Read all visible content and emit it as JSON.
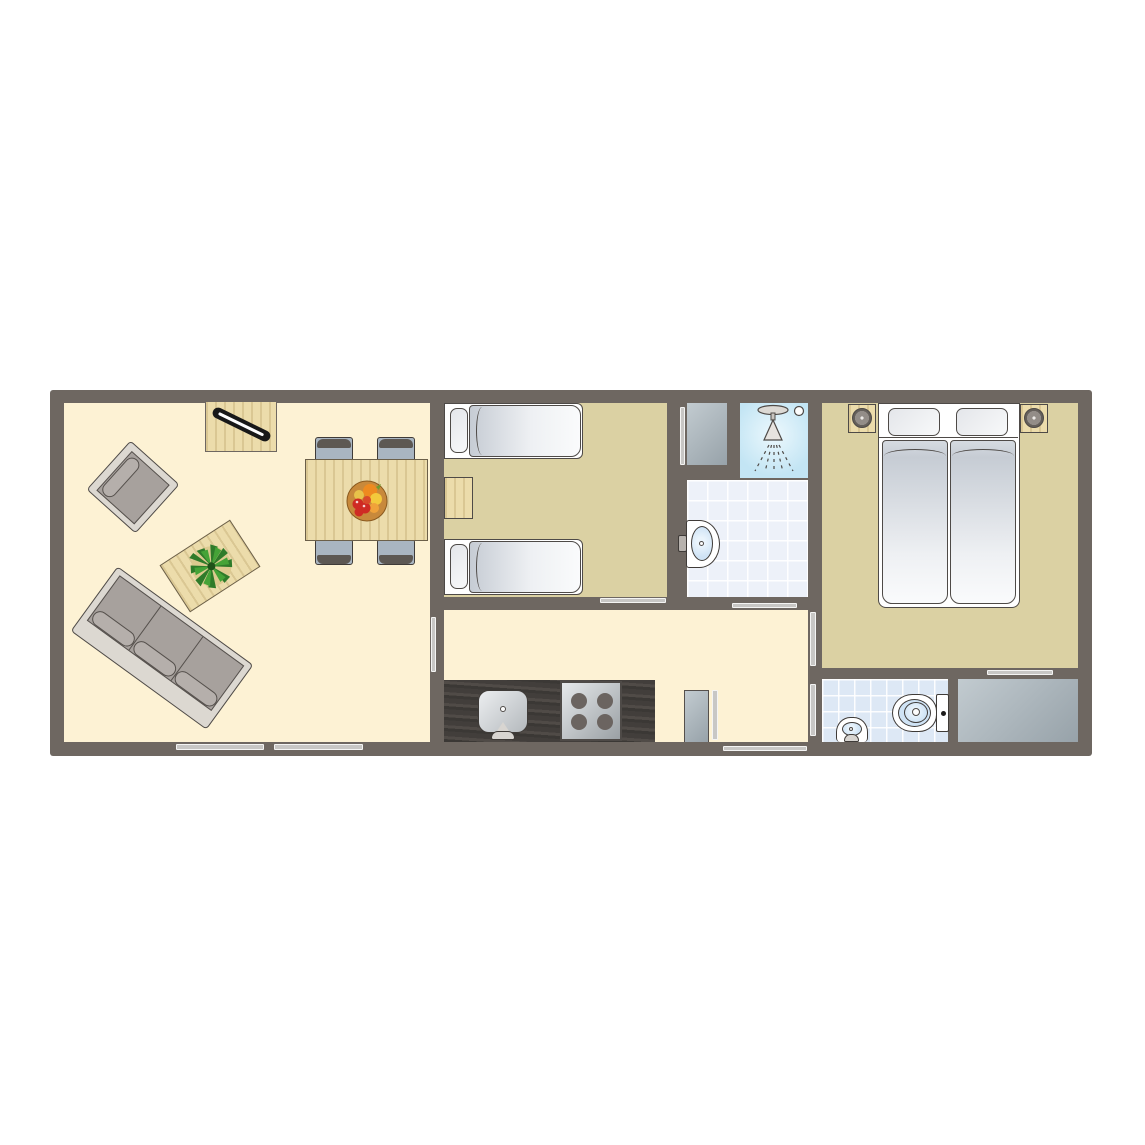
{
  "document": {
    "type": "architectural floor plan",
    "description": "Top-down floor plan of a single-storey holiday lodge: open living/dining room on the left, twin bedroom and bathroom in the middle, double bedroom on the right, kitchen corridor along the bottom with separate toilet room and storage room"
  },
  "rooms": [
    {
      "id": "living-room",
      "label": "living-dining-room"
    },
    {
      "id": "twin-bedroom",
      "label": "bedroom-two-single-beds"
    },
    {
      "id": "bathroom",
      "label": "bathroom-shower-washbasin"
    },
    {
      "id": "double-bedroom",
      "label": "bedroom-double-bed"
    },
    {
      "id": "hallway-kitchen",
      "label": "hallway-with-kitchenette"
    },
    {
      "id": "toilet-room",
      "label": "separate-toilet"
    },
    {
      "id": "storage-room",
      "label": "storage"
    },
    {
      "id": "closet-bathroom",
      "label": "utility-closet"
    },
    {
      "id": "closet-hall",
      "label": "hall-closet"
    }
  ],
  "furniture": {
    "living_room": [
      "tv-cabinet-with-tv",
      "armchair",
      "three-seat-sofa",
      "coffee-table-with-plant",
      "dining-table-with-fruit-bowl",
      "dining-chair",
      "dining-chair",
      "dining-chair",
      "dining-chair"
    ],
    "twin_bedroom": [
      "single-bed",
      "single-bed",
      "nightstand"
    ],
    "bathroom": [
      "shower",
      "washbasin"
    ],
    "double_bedroom": [
      "double-bed",
      "nightstand-with-lamp",
      "nightstand-with-lamp"
    ],
    "kitchen": [
      "kitchen-counter",
      "sink",
      "stove-four-burners"
    ],
    "toilet_room": [
      "toilet",
      "washbasin"
    ]
  },
  "openings": {
    "windows_bottom_wall": 2,
    "front_door": 1,
    "interior_door_bars": [
      "living-to-hall",
      "hall-to-twin-bedroom",
      "hall-to-bathroom",
      "hall-to-double-bedroom",
      "hall-to-toilet",
      "bedroom-to-storage",
      "twin-bedroom-closet",
      "hall-closet"
    ]
  },
  "colors": {
    "wall": "#6e6761",
    "floor_living": "#fdf2d4",
    "floor_bedroom": "#dbd1a3",
    "tile_bath": "#edf1f9",
    "tile_toilet": "#dde8f5",
    "shower_blue": "#c3e5f4",
    "shower_light": "#ecf8fd",
    "bar_door_window": "#c8c7c5",
    "counter_dark": "#45413e",
    "wood_light": "#ecdcab",
    "closet_gray_dark": "#97a2a9",
    "closet_gray_light": "#c2cbd0",
    "outline": "#4e4a47",
    "mattress_gray": "#c6ccd4",
    "sofa_frame": "#dcd8d1",
    "sofa_seat": "#a7a19d",
    "cushion": "#b5afab",
    "chair_seat": "#a9b5c1",
    "chair_back": "#5d5853",
    "burner": "#6b6460",
    "plant_green": "#2f7b2a",
    "fruit_bowl": "#c8893b",
    "basin_blue": "#cfe3f5"
  }
}
